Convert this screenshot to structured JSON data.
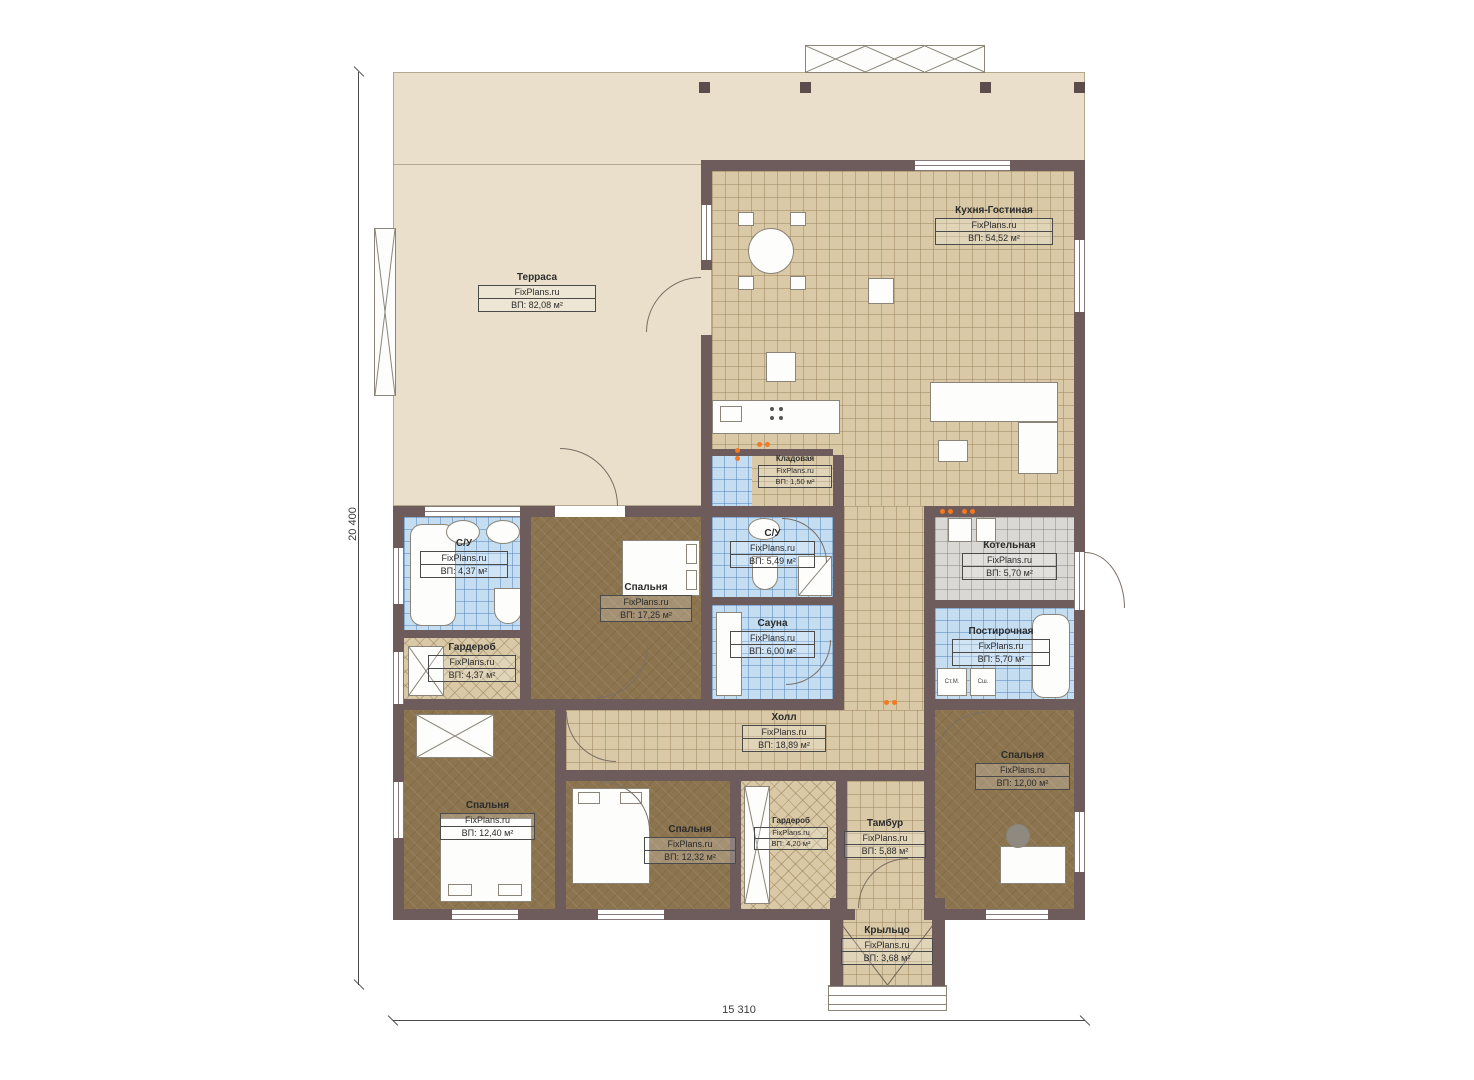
{
  "plan": {
    "brand": "FixPlans.ru",
    "dimensions": {
      "height_label": "20 400",
      "width_label": "15 310"
    },
    "rooms": {
      "terrace": {
        "name": "Терраса",
        "area": "ВП: 82,08 м²"
      },
      "kitchen_living": {
        "name": "Кухня-Гостиная",
        "area": "ВП: 54,52 м²"
      },
      "storage": {
        "name": "Кладовая",
        "area": "ВП: 1,50 м²"
      },
      "bathroom_center": {
        "name": "С/У",
        "area": "ВП: 5,49 м²"
      },
      "sauna": {
        "name": "Сауна",
        "area": "ВП: 6,00 м²"
      },
      "bathroom_left": {
        "name": "С/У",
        "area": "ВП: 4,37 м²"
      },
      "wardrobe_left": {
        "name": "Гардероб",
        "area": "ВП: 4,37 м²"
      },
      "bedroom_center": {
        "name": "Спальня",
        "area": "ВП: 17,25 м²"
      },
      "boiler": {
        "name": "Котельная",
        "area": "ВП: 5,70 м²"
      },
      "laundry": {
        "name": "Постирочная",
        "area": "ВП: 5,70 м²"
      },
      "hall": {
        "name": "Холл",
        "area": "ВП: 18,89 м²"
      },
      "bedroom_left": {
        "name": "Спальня",
        "area": "ВП: 12,40 м²"
      },
      "bedroom_mid": {
        "name": "Спальня",
        "area": "ВП: 12,32 м²"
      },
      "bedroom_right": {
        "name": "Спальня",
        "area": "ВП: 12,00 м²"
      },
      "wardrobe_bottom": {
        "name": "Гардероб",
        "area": "ВП: 4,20 м²"
      },
      "vestibule": {
        "name": "Тамбур",
        "area": "ВП: 5,88 м²"
      },
      "porch": {
        "name": "Крыльцо",
        "area": "ВП: 3,68 м²"
      }
    },
    "appliances": {
      "washer": "Ст.М.",
      "dryer": "Сш."
    },
    "colors": {
      "wall": "#6e5b5b",
      "terrace": "#e9dfca",
      "tile_tan": "#d9c9a6",
      "tile_blue": "#c5ddf1",
      "tile_gray": "#dad8d4",
      "floor_brown": "#8c744e",
      "accent_orange": "#f4791f"
    }
  }
}
